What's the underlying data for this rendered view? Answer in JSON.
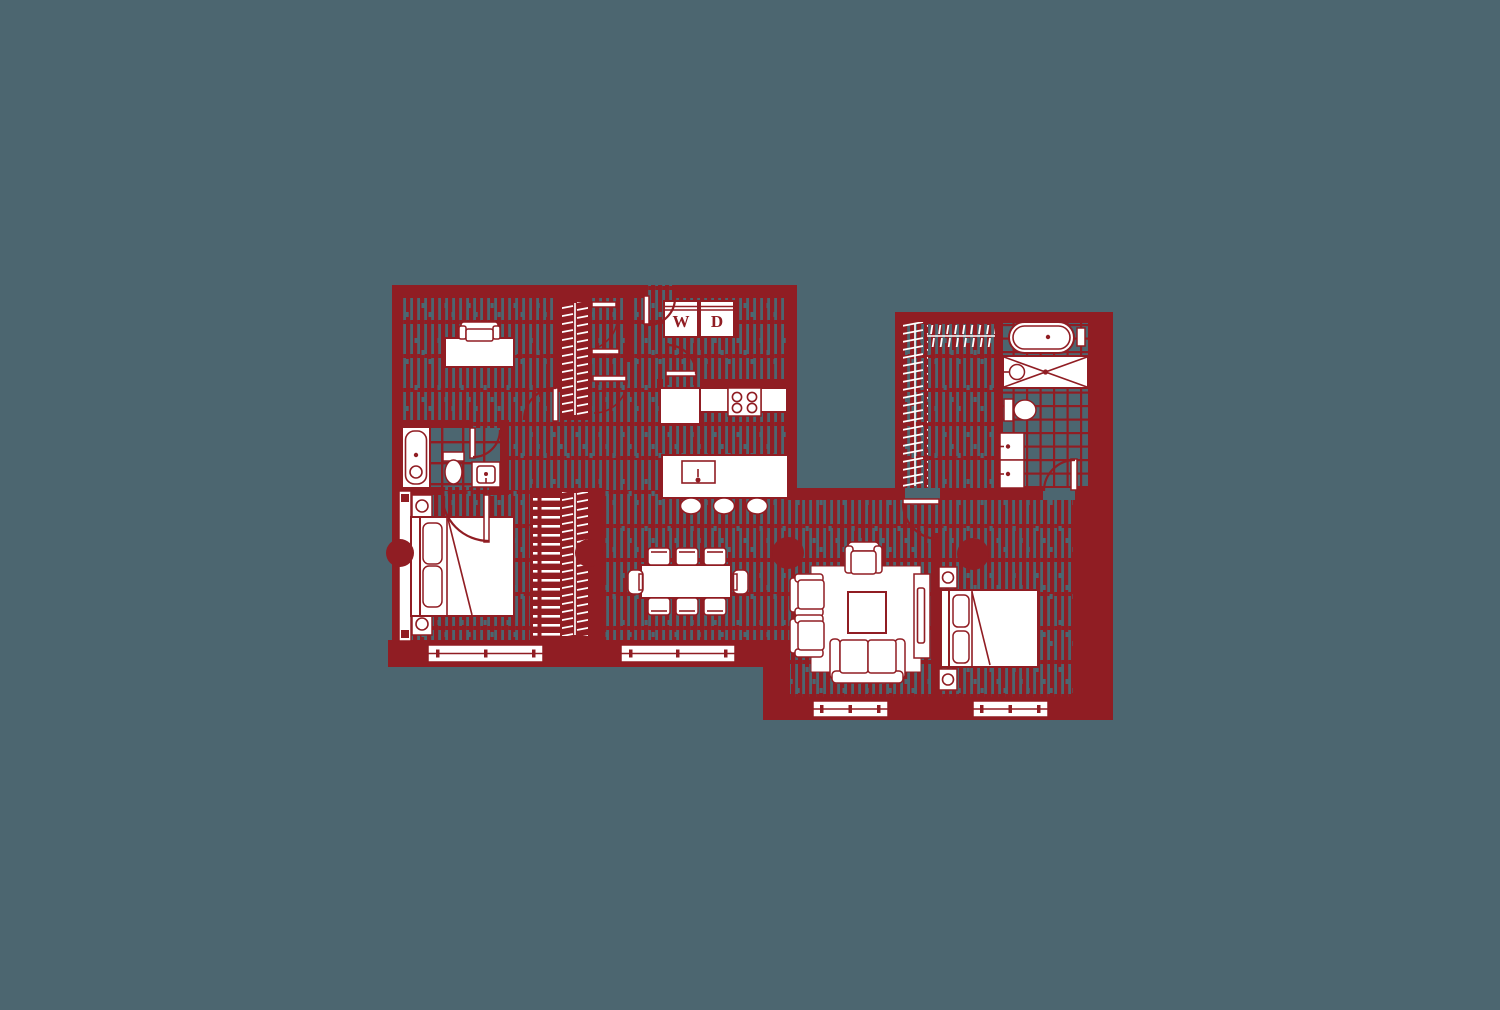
{
  "canvas": {
    "width": 1500,
    "height": 1010,
    "background": "#4C6670"
  },
  "palette": {
    "wall_ink": "#901D23",
    "fixture_white": "#FFFFFF",
    "floor_slate": "#4C6670"
  },
  "floor_plan": {
    "laundry": {
      "washer_label": "W",
      "dryer_label": "D"
    }
  }
}
